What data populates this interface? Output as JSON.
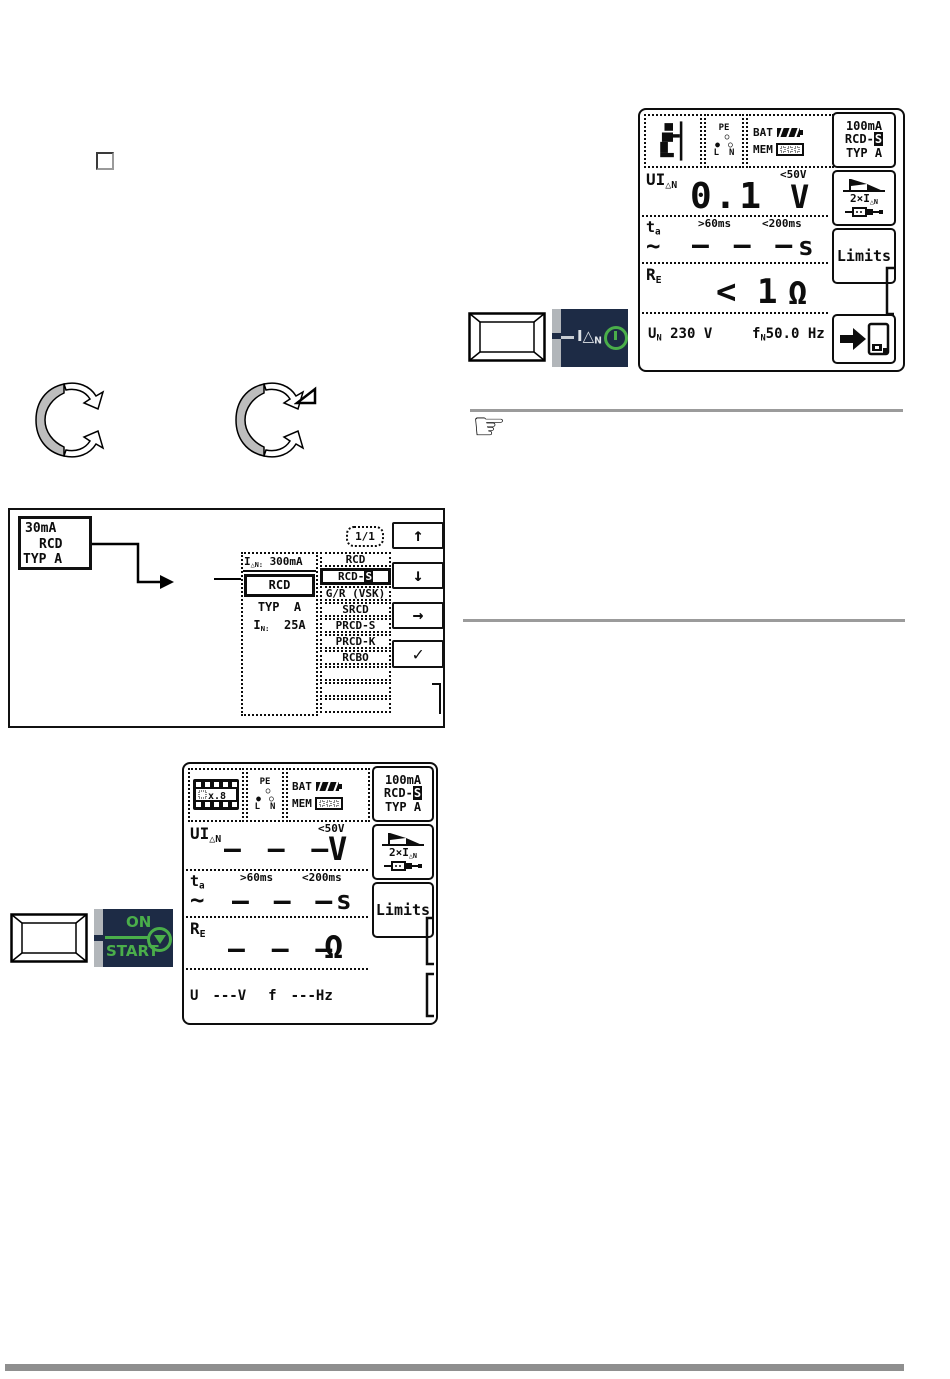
{
  "colors": {
    "panel_navy": "#1d2b45",
    "green": "#4aae4a",
    "tab_gray": "#b2b6ba",
    "rule_gray": "#9b9b9b",
    "bottom_bar_gray": "#8f8f8f"
  },
  "icons": {
    "status_person": "person-at-pole-icon",
    "status_film": "film-strip-icon",
    "status_socket": "socket-pe-ln-icon",
    "battery": "battery-icon",
    "memory": "memory-icon",
    "test_curve": "trip-curve-flag-icon",
    "plug": "plug-adapter-icon",
    "save": "arrow-to-disk-save-icon",
    "knob": "rotary-knob-icon",
    "note": "pointing-hand-icon",
    "key": "device-key-icon",
    "power": "power-on-icon",
    "start_triangle": "start-triangle-icon"
  },
  "display1": {
    "status": {
      "bat": "BAT",
      "mem": "MEM",
      "pe": "PE",
      "l": "L",
      "n": "N",
      "socket_dot_filled": "●",
      "socket_dot_open": "○"
    },
    "softkeys": {
      "range_line1": "100mA",
      "range_line2_prefix": "RCD-",
      "range_line2_inverted": "S",
      "range_line3": "TYP A",
      "test_main": "2×I",
      "test_sub": "△N",
      "limits": "Limits"
    },
    "u_row": {
      "label_main": "UI",
      "label_sub": "△N",
      "limit": "<50V",
      "value": "0.1",
      "unit": "V"
    },
    "ta_row": {
      "label_main": "t",
      "label_sub": "a",
      "wave": "~",
      "limit_low": ">60ms",
      "limit_high": "<200ms",
      "value": "– – –",
      "unit": "s"
    },
    "re_row": {
      "label_main": "R",
      "label_sub": "E",
      "value": "< 1",
      "unit": "Ω"
    },
    "footer": {
      "un_main": "U",
      "un_sub": "N",
      "un_value": "230 V",
      "fn_main": "f",
      "fn_sub": "N",
      "fn_value": "50.0 Hz"
    }
  },
  "display2": {
    "status": {
      "bat": "BAT",
      "mem": "MEM",
      "pe": "PE",
      "l": "L",
      "n": "N",
      "socket_dot_filled": "●",
      "socket_dot_open": "○",
      "film_text": "x.8"
    },
    "softkeys": {
      "range_line1": "100mA",
      "range_line2_prefix": "RCD-",
      "range_line2_inverted": "S",
      "range_line3": "TYP A",
      "test_main": "2×I",
      "test_sub": "△N",
      "limits": "Limits"
    },
    "u_row": {
      "label_main": "UI",
      "label_sub": "△N",
      "limit": "<50V",
      "value": "– – –",
      "unit": "V"
    },
    "ta_row": {
      "label_main": "t",
      "label_sub": "a",
      "wave": "~",
      "limit_low": ">60ms",
      "limit_high": "<200ms",
      "value": "– – –",
      "unit": "s"
    },
    "re_row": {
      "label_main": "R",
      "label_sub": "E",
      "value": "– – –",
      "unit": "Ω"
    },
    "footer": {
      "u_label": "U",
      "u_dashes": "---",
      "u_unit": "V",
      "f_label": "f",
      "f_dashes": "---",
      "f_unit": "Hz"
    }
  },
  "selector_figure": {
    "source_key": {
      "line1": "30mA",
      "line2": "RCD",
      "line3": "TYP A"
    },
    "page_indicator": "1/1",
    "params": {
      "header_main": "I",
      "header_sub": "△N:",
      "header_value": "300mA",
      "selected": "RCD",
      "typ_line": "TYP  A",
      "in_main": "I",
      "in_sub": "N:",
      "in_value": "25A"
    },
    "selected_type_prefix": "RCD-",
    "selected_type_inverted": "S",
    "types": [
      "RCD",
      "",
      "G/R (VSK)",
      "SRCD",
      "PRCD-S",
      "PRCD-K",
      "RCBO",
      "",
      "",
      ""
    ],
    "softkeys": {
      "up": "↑",
      "down": "↓",
      "right": "→",
      "confirm": "✓"
    }
  },
  "keys": {
    "idn": {
      "label_main": "I△",
      "label_sub": "N"
    },
    "start": {
      "on": "ON",
      "start": "START"
    }
  }
}
